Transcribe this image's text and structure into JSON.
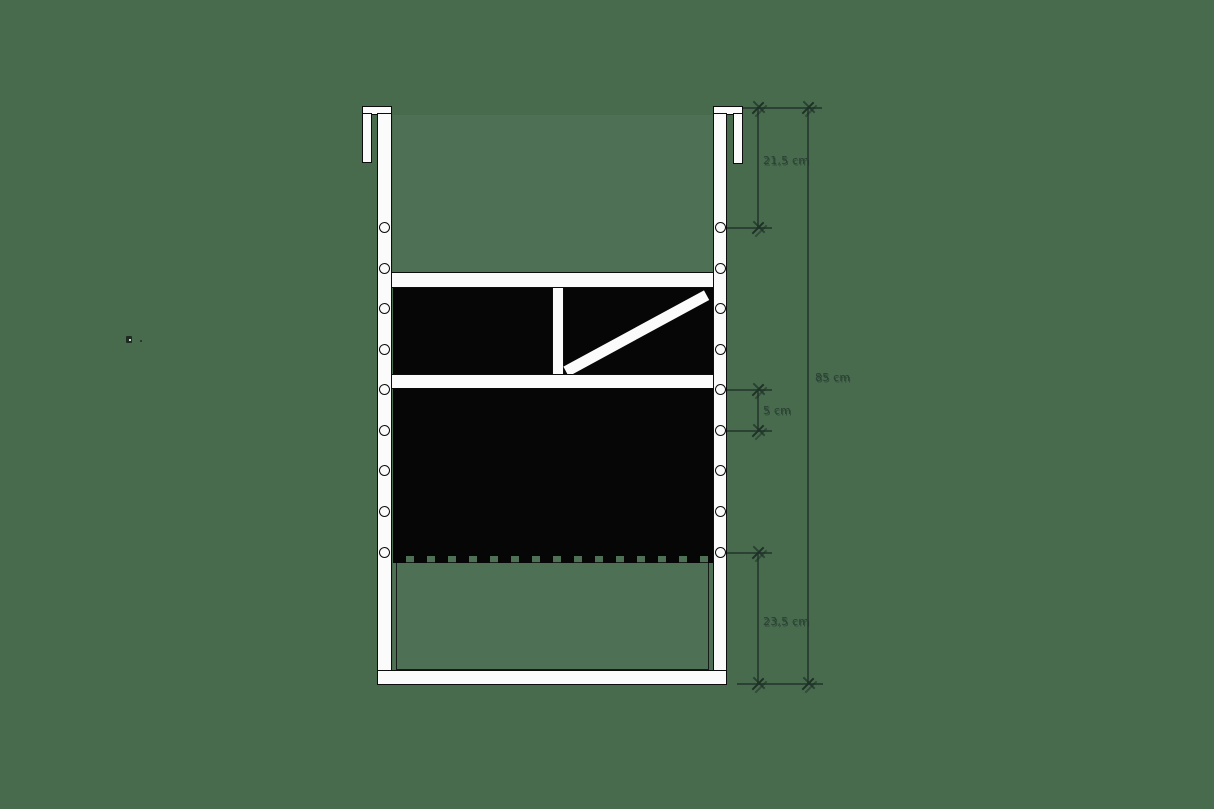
{
  "title": "hanging frame technical drawing",
  "colors": {
    "background": "#486B4E",
    "outline": "#0D0D0D",
    "fill_white": "#FBFBFB",
    "fill_black": "#060606",
    "dimension": "#2B4134"
  },
  "dimensions": [
    {
      "id": "dim-hook-to-first-hole",
      "label": "21,5 cm"
    },
    {
      "id": "dim-overall-height",
      "label": "85 cm"
    },
    {
      "id": "dim-hole-spacing",
      "label": "5 cm"
    },
    {
      "id": "dim-panel-to-bottom",
      "label": "23,5 cm"
    }
  ]
}
